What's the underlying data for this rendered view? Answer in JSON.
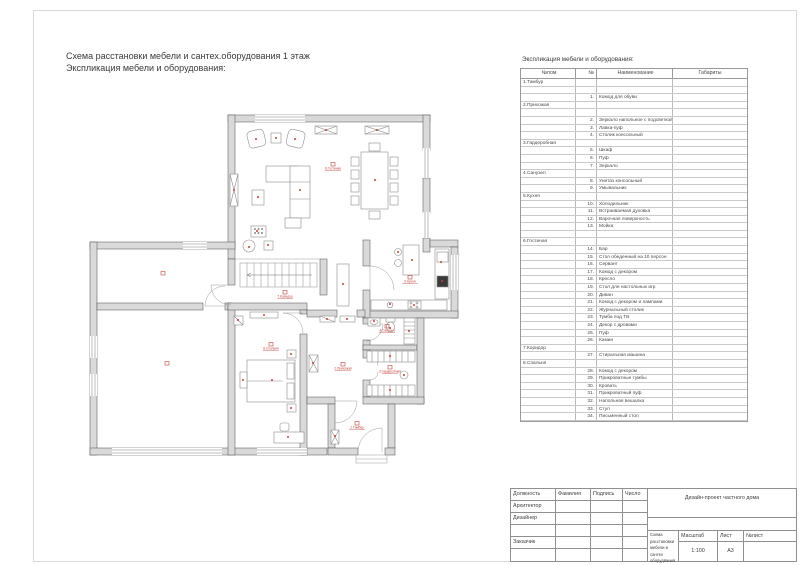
{
  "page": {
    "title_line1": "Схема расстановки мебели и сантех.оборудования 1 этаж",
    "title_line2": "Экспликация мебели и оборудования:"
  },
  "explication": {
    "title": "Экспликация мебели и оборудования:",
    "columns": [
      "№пом",
      "№",
      "Наименование",
      "Габариты"
    ],
    "rows": [
      [
        "1.Тамбур",
        "",
        ""
      ],
      [
        "",
        "",
        ""
      ],
      [
        "",
        "1.",
        "Комод для обуви"
      ],
      [
        "2.Прихожая",
        "",
        ""
      ],
      [
        "",
        "",
        ""
      ],
      [
        "",
        "2.",
        "Зеркало напольное с подсветкой"
      ],
      [
        "",
        "3.",
        "Лавка-пуф"
      ],
      [
        "",
        "4.",
        "Столик консольный"
      ],
      [
        "3.Гардеробная",
        "",
        ""
      ],
      [
        "",
        "5.",
        "Шкаф"
      ],
      [
        "",
        "6.",
        "Пуф"
      ],
      [
        "",
        "7.",
        "Зеркало"
      ],
      [
        "4.Санузел",
        "",
        ""
      ],
      [
        "",
        "8.",
        "Унитаз консольный"
      ],
      [
        "",
        "9.",
        "Умывальник"
      ],
      [
        "5.Кухня",
        "",
        ""
      ],
      [
        "",
        "10.",
        "Холодильник"
      ],
      [
        "",
        "11.",
        "Встраиваемая духовка"
      ],
      [
        "",
        "12.",
        "Варочная поверхность"
      ],
      [
        "",
        "13.",
        "Мойка"
      ],
      [
        "",
        "",
        ""
      ],
      [
        "6.Гостиная",
        "",
        ""
      ],
      [
        "",
        "14.",
        "Бар"
      ],
      [
        "",
        "15.",
        "Стол обеденный на 10 персон"
      ],
      [
        "",
        "16.",
        "Сервант"
      ],
      [
        "",
        "17.",
        "Комод с декором"
      ],
      [
        "",
        "18.",
        "Кресло"
      ],
      [
        "",
        "19.",
        "Стол для настольных игр"
      ],
      [
        "",
        "20.",
        "Диван"
      ],
      [
        "",
        "21.",
        "Комод с декором и лампами"
      ],
      [
        "",
        "22.",
        "Журнальный столик"
      ],
      [
        "",
        "23.",
        "Тумба под ТВ"
      ],
      [
        "",
        "24.",
        "Декор с дровами"
      ],
      [
        "",
        "25.",
        "Пуф"
      ],
      [
        "",
        "26.",
        "Камин"
      ],
      [
        "7.Коридор",
        "",
        ""
      ],
      [
        "",
        "27.",
        "Стиральная машина"
      ],
      [
        "8.Спальня",
        "",
        ""
      ],
      [
        "",
        "28.",
        "Комод с декором"
      ],
      [
        "",
        "29.",
        "Прикроватные тумбы"
      ],
      [
        "",
        "30.",
        "Кровать"
      ],
      [
        "",
        "31.",
        "Прикроватный пуф"
      ],
      [
        "",
        "32.",
        "Напольная вешалка"
      ],
      [
        "",
        "33.",
        "Стул"
      ],
      [
        "",
        "34.",
        "Письменный стол"
      ]
    ]
  },
  "plan": {
    "room_labels": [
      {
        "name": "6.Гостиная",
        "x": 333,
        "y": 168
      },
      {
        "name": "5.Кухня",
        "x": 410,
        "y": 281
      },
      {
        "name": "7.Коридор",
        "x": 285,
        "y": 296
      },
      {
        "name": "8.Спальня",
        "x": 271,
        "y": 348
      },
      {
        "name": "4.Санузел",
        "x": 387,
        "y": 330
      },
      {
        "name": "3.Гардеробная",
        "x": 390,
        "y": 371
      },
      {
        "name": "2.Прихожая",
        "x": 343,
        "y": 368
      },
      {
        "name": "1.Тамбур",
        "x": 357,
        "y": 427
      },
      {
        "name": "",
        "x": 163,
        "y": 277
      },
      {
        "name": "",
        "x": 167,
        "y": 367
      }
    ],
    "colors": {
      "wall_fill": "#d9d9d9",
      "wall_line": "#4d4d4d",
      "furniture_line": "#8c8c8c",
      "accent_red": "#c2413b"
    }
  },
  "titleblock": {
    "col_headers": [
      "Должность",
      "Фамилия",
      "Подпись",
      "Число"
    ],
    "role_rows": [
      "Архитектор",
      "Дизайнер",
      "",
      "Заказчик",
      ""
    ],
    "project_title": "Дизайн-проект частного дома",
    "drawing_title": "Схема расстановки мебели и сантех оборудвания",
    "scale_label": "Масштаб",
    "scale_value": "1:100",
    "sheet_label": "Лист",
    "sheet_value": "А3",
    "sheet_no_label": "№лист"
  }
}
